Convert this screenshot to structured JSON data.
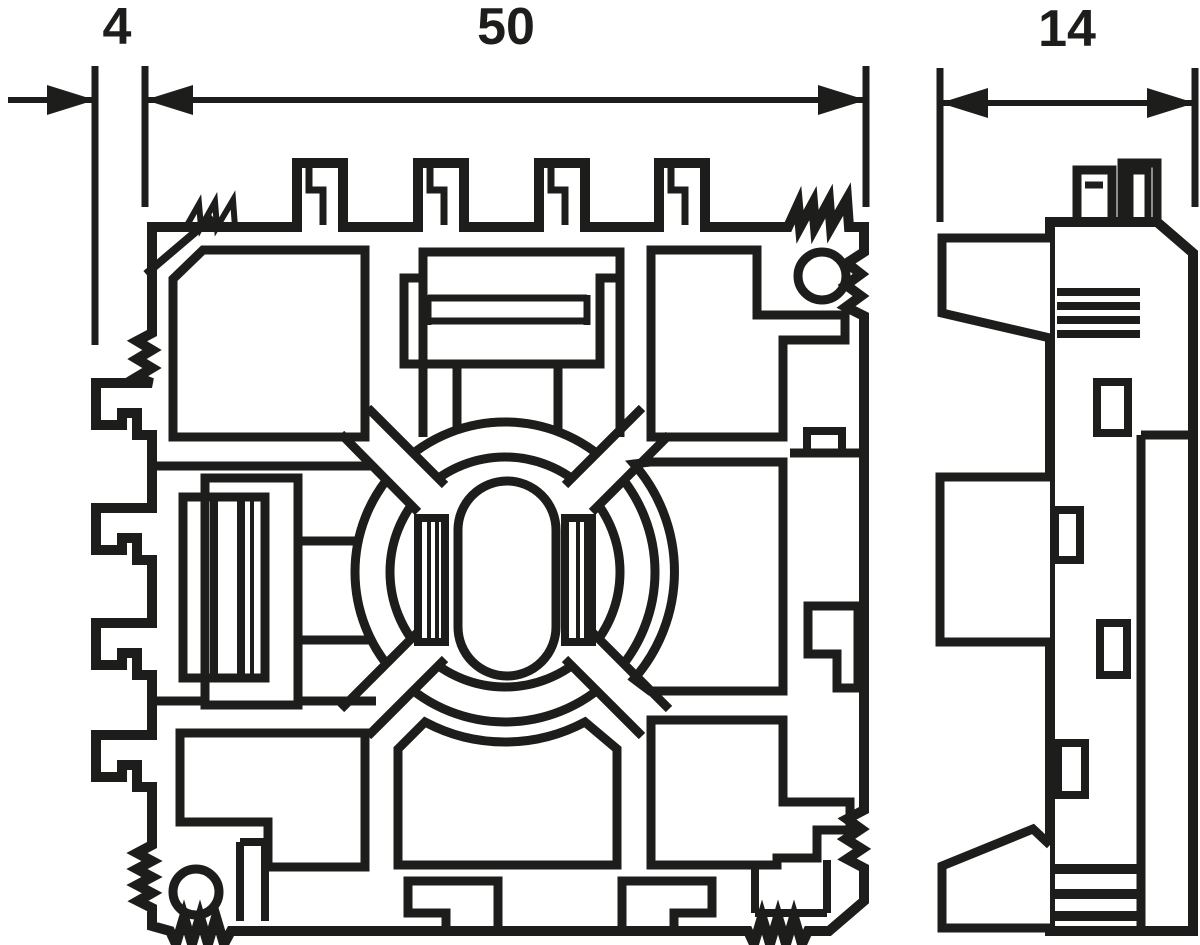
{
  "drawing": {
    "type": "technical-section-drawing",
    "colors": {
      "ink": "#1d1d1b",
      "paper": "#ffffff"
    },
    "dimensions": {
      "hook_depth": {
        "label": "4"
      },
      "overall_width": {
        "label": "50"
      },
      "profile_depth": {
        "label": "14"
      }
    },
    "views": {
      "front": {
        "name": "front-section-view"
      },
      "side": {
        "name": "side-profile-view"
      }
    }
  }
}
